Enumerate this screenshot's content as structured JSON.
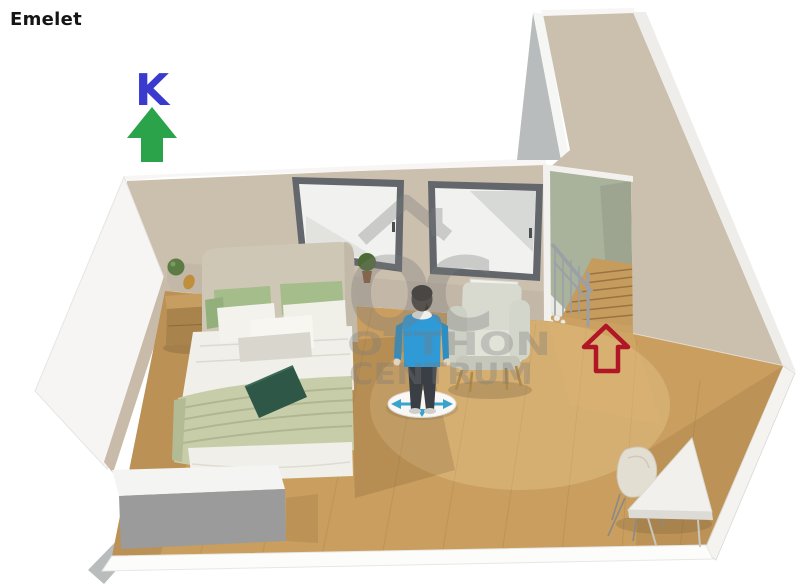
{
  "page": {
    "title": "Emelet",
    "background": "#ffffff"
  },
  "compass": {
    "letter": "K",
    "letter_color": "#3a3ace",
    "arrow_color": "#2ba34a",
    "direction": "up"
  },
  "entry_arrow": {
    "color": "#b01626",
    "style": "outline",
    "direction": "up"
  },
  "watermark": {
    "monogram": "OC",
    "line1": "OTTHON",
    "line2": "CENTRUM",
    "color": "#7a7a7a"
  },
  "scene": {
    "type": "3d-floorplan-render",
    "room_label": "upper-floor bedroom with staircase",
    "colors": {
      "wall": "#cbbfae",
      "wall_bright": "#d2c8b8",
      "wall_cut_white": "#f6f5f3",
      "floor": "#c99e5f",
      "stair_wall_green": "#a9b29b",
      "stair_wood": "#c59c5e",
      "window_frame": "#63676b",
      "window_glass": "#f1f2f0",
      "headboard": "#cfc7b6",
      "pillow_green": "#a5bd8a",
      "pillow_green_dark": "#93b07c",
      "blanket_green": "#c8cda9",
      "cushion_dark_green": "#2e5747",
      "linen_white": "#f0efe9",
      "wood": "#c79e61",
      "wood_dark": "#a9834c",
      "sweater_blue": "#2f9ad6",
      "pants_dark": "#3a3f45",
      "sideboard_front_gray": "#9b9b9b",
      "sideboard_top_white": "#f4f4f3",
      "armchair_gray": "#d8dacf",
      "armchair_seat": "#e1e2d8",
      "railing_gray": "#9aa0a6",
      "disk_arrow_blue": "#38a3cd",
      "lamp_green": "#5d7c45",
      "plant_green": "#4e6b35",
      "gray_edge": "#b9bcbd"
    },
    "objects": [
      "double-bed",
      "headboard",
      "pillows",
      "throw-blanket",
      "dark-green-cushion",
      "nightstand",
      "wall-lamp",
      "window-left",
      "window-right",
      "potted-plant",
      "radiator",
      "armchair",
      "standing-person-avatar",
      "move-disk",
      "staircase",
      "stair-railing",
      "decor-pebbles",
      "sideboard",
      "corner-desk",
      "desk-chair"
    ]
  }
}
